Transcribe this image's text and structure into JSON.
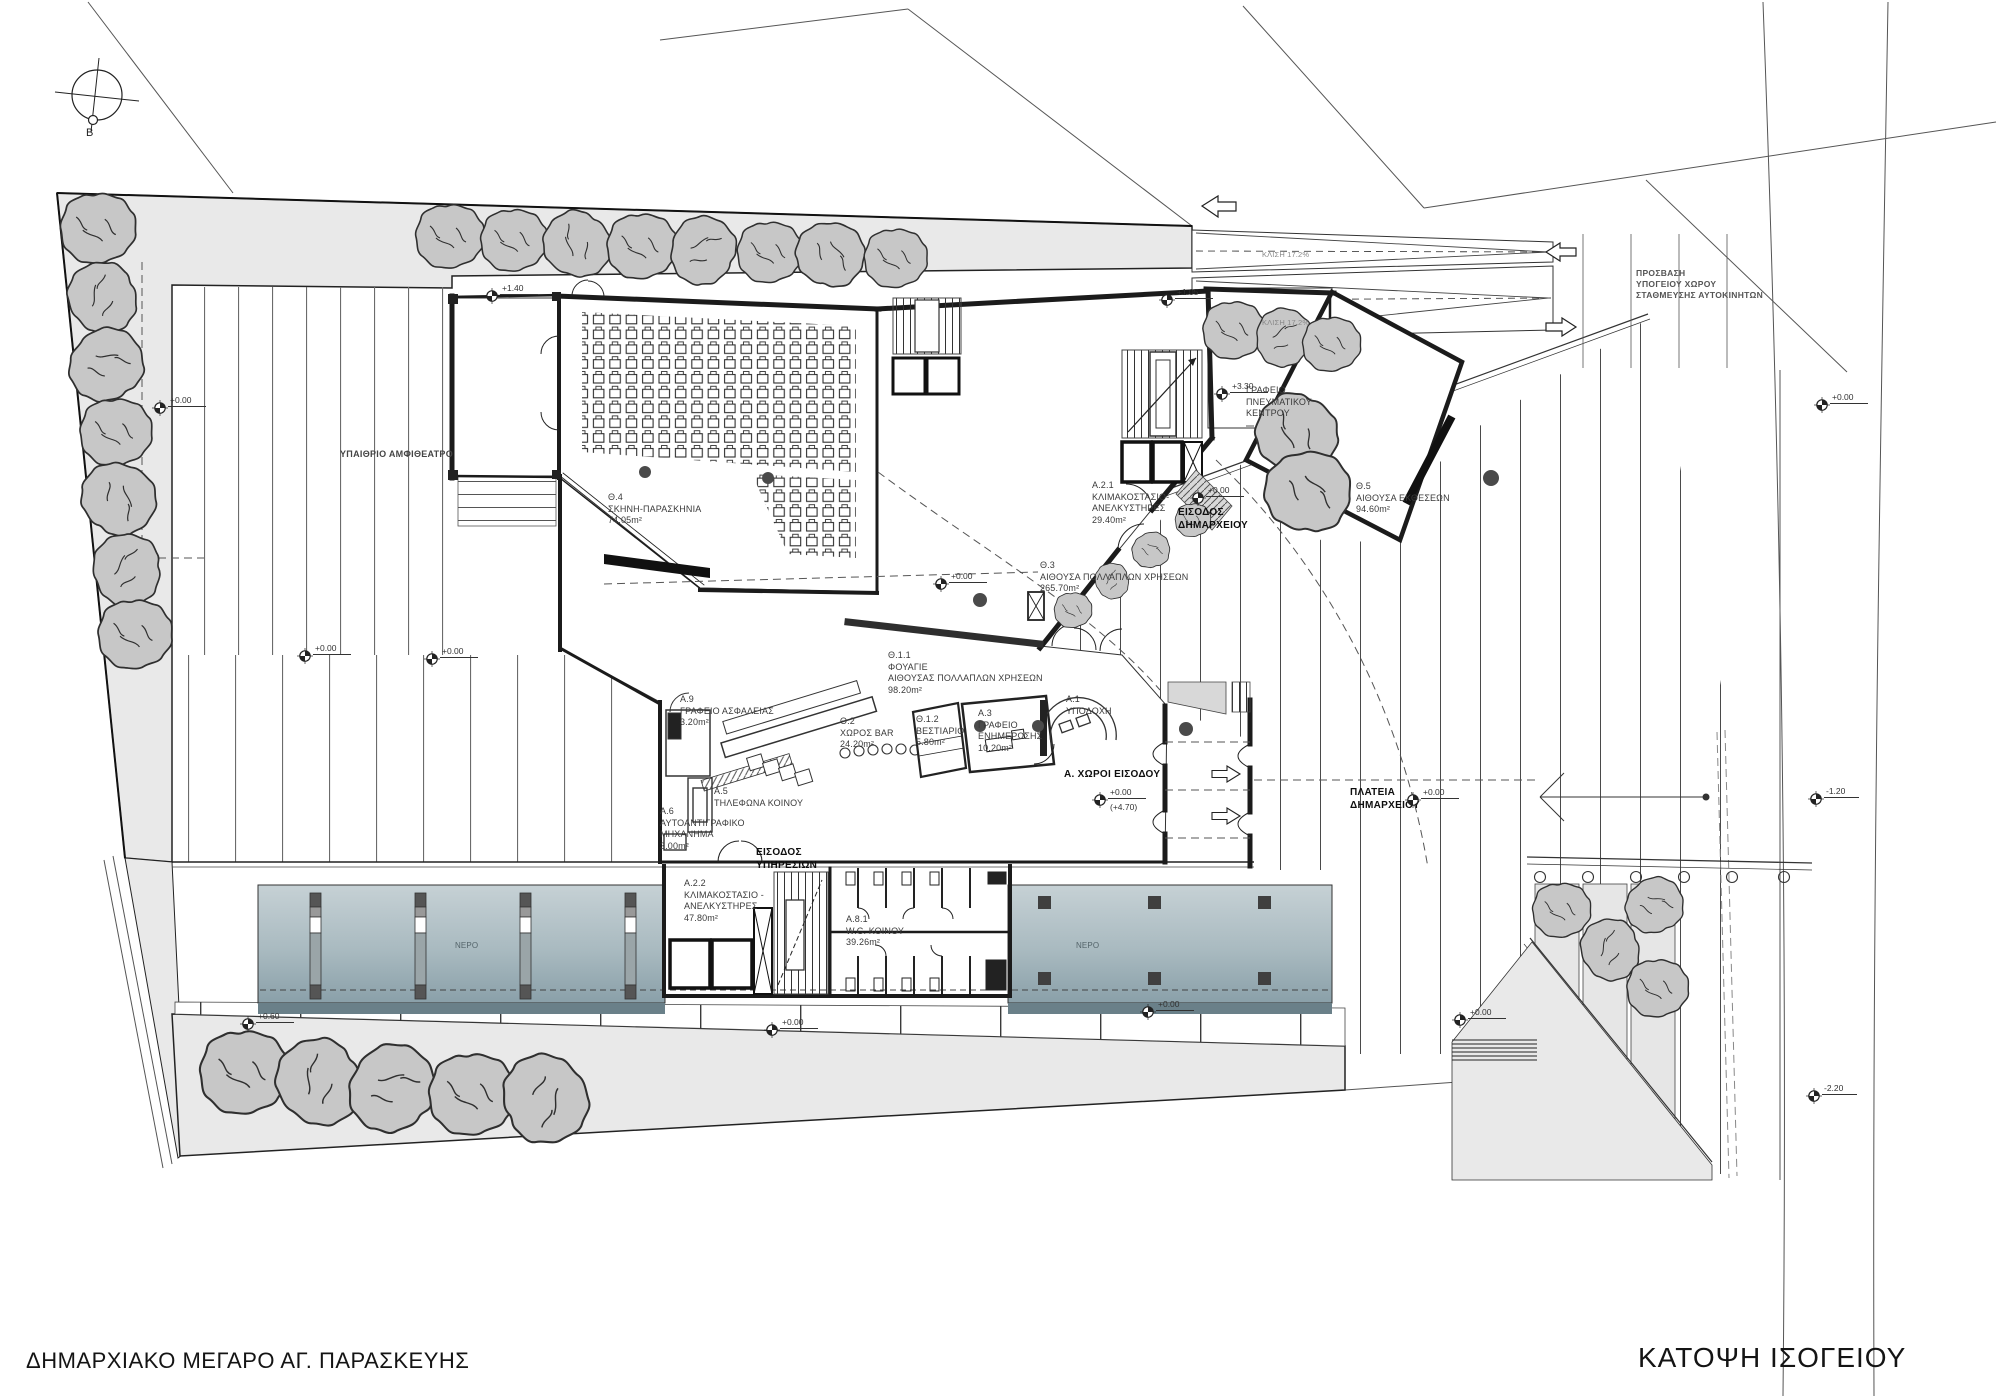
{
  "titles": {
    "project": "ΔΗΜΑΡΧΙΑΚΟ ΜΕΓΑΡΟ ΑΓ. ΠΑΡΑΣΚΕΥΗΣ",
    "drawing": "ΚΑΤΟΨΗ ΙΣΟΓΕΙΟΥ"
  },
  "colors": {
    "site_gray": "#e9e9e9",
    "tree_fill": "#c7c7c7",
    "wall": "#1b1b1b",
    "water_top": "#c6d1d5",
    "water_bottom": "#8aa0a9",
    "water_edge": "#6a8089",
    "canopy_gray": "#d8d8d8"
  },
  "plan_labels": [
    {
      "name": "compass-north-label",
      "text": "Β",
      "x": 86,
      "y": 126,
      "size": 11,
      "color": "#222222"
    },
    {
      "name": "area-open-amphitheater",
      "text": "ΥΠΑΙΘΡΙΟ ΑΜΦΙΘΕΑΤΡΟ",
      "x": 340,
      "y": 449,
      "size": 9,
      "bold": true,
      "color": "#444444"
    },
    {
      "name": "room-th4",
      "text": "Θ.4\nΣΚΗΝΗ-ΠΑΡΑΣΚΗΝΙΑ\n74.05m²",
      "x": 608,
      "y": 492
    },
    {
      "name": "room-th5",
      "text": "Θ.5\nΑΙΘΟΥΣΑ ΕΚΘΕΣΕΩΝ\n94.60m²",
      "x": 1356,
      "y": 481
    },
    {
      "name": "room-th3",
      "text": "Θ.3\nΑΙΘΟΥΣΑ ΠΟΛΛΑΠΛΩΝ ΧΡΗΣΕΩΝ\n265.70m²",
      "x": 1040,
      "y": 560
    },
    {
      "name": "room-th11",
      "text": "Θ.1.1\nΦΟΥΑΓΙΕ\nΑΙΘΟΥΣΑΣ ΠΟΛΛΑΠΛΩΝ ΧΡΗΣΕΩΝ\n98.20m²",
      "x": 888,
      "y": 650
    },
    {
      "name": "room-th2",
      "text": "Θ.2\nΧΩΡΟΣ BAR\n24.20m²",
      "x": 840,
      "y": 716
    },
    {
      "name": "room-th12",
      "text": "Θ.1.2\nΒΕΣΤΙΑΡΙΟ\n5.80m²",
      "x": 916,
      "y": 714
    },
    {
      "name": "room-a3",
      "text": "Α.3\nΓΡΑΦΕΙΟ\nΕΝΗΜΕΡΩΣΗΣ\n10.20m²",
      "x": 978,
      "y": 708
    },
    {
      "name": "room-a1",
      "text": "Α.1\nΥΠΟΔΟΧΗ",
      "x": 1066,
      "y": 694
    },
    {
      "name": "room-a9",
      "text": "Α.9\nΓΡΑΦΕΙΟ ΑΣΦΑΛΕΙΑΣ\n3.20m²",
      "x": 680,
      "y": 694
    },
    {
      "name": "room-a5",
      "text": "Α.5\nΤΗΛΕΦΩΝΑ ΚΟΙΝΟΥ",
      "x": 714,
      "y": 786
    },
    {
      "name": "room-a6",
      "text": "Α.6\nΑΥΤΟΑΝΤΙΓΡΑΦΙΚΟ\nΜΗΧΑΝΗΜΑ\n3.00m²",
      "x": 660,
      "y": 806
    },
    {
      "name": "room-a21",
      "text": "Α.2.1\nΚΛΙΜΑΚΟΣΤΑΣΙΟ-\nΑΝΕΛΚΥΣΤΗΡΕΣ\n29.40m²",
      "x": 1092,
      "y": 480
    },
    {
      "name": "room-a22",
      "text": "Α.2.2\nΚΛΙΜΑΚΟΣΤΑΣΙΟ -\nΑΝΕΛΚΥΣΤΗΡΕΣ\n47.80m²",
      "x": 684,
      "y": 878
    },
    {
      "name": "room-a81",
      "text": "Α.8.1\nW.C. ΚΟΙΝΟΥ\n39.26m²",
      "x": 846,
      "y": 914
    },
    {
      "name": "room-cultural-office",
      "text": "ΓΡΑΦΕΙΟ\nΠΝΕΥΜΑΤΙΚΟΥ\nΚΕΝΤΡΟΥ",
      "x": 1246,
      "y": 385
    },
    {
      "name": "entrance-city-hall",
      "text": "ΕΙΣΟΔΟΣ\nΔΗΜΑΡΧΕΙΟΥ",
      "x": 1178,
      "y": 506,
      "bold": true
    },
    {
      "name": "entrance-services",
      "text": "ΕΙΣΟΔΟΣ\nΥΠΗΡΕΣΙΩΝ",
      "x": 756,
      "y": 846,
      "bold": true
    },
    {
      "name": "area-entrance-spaces",
      "text": "Α. ΧΩΡΟΙ ΕΙΣΟΔΟΥ",
      "x": 1064,
      "y": 768,
      "bold": true
    },
    {
      "name": "area-city-hall-square",
      "text": "ΠΛΑΤΕΙΑ\nΔΗΜΑΡΧΕΙΟΥ",
      "x": 1350,
      "y": 786,
      "bold": true
    },
    {
      "name": "parking-access",
      "text": "ΠΡΟΣΒΑΣΗ\nΥΠΟΓΕΙΟΥ ΧΩΡΟΥ\nΣΤΑΘΜΕΥΣΗΣ ΑΥΤΟΚΙΝΗΤΩΝ",
      "x": 1636,
      "y": 268,
      "size": 8.5,
      "bold": true,
      "color": "#555555"
    },
    {
      "name": "ramp-slope-1",
      "text": "ΚΛΙΣΗ 17.2%",
      "x": 1262,
      "y": 250,
      "size": 7.5,
      "color": "#888888"
    },
    {
      "name": "ramp-slope-2",
      "text": "ΚΛΙΣΗ 17.2%",
      "x": 1262,
      "y": 318,
      "size": 7.5,
      "color": "#888888"
    },
    {
      "name": "water-label-1",
      "text": "ΝΕΡΟ",
      "x": 455,
      "y": 941,
      "size": 8,
      "color": "#54646a"
    },
    {
      "name": "water-label-2",
      "text": "ΝΕΡΟ",
      "x": 1076,
      "y": 941,
      "size": 8,
      "color": "#54646a"
    }
  ],
  "level_marks": [
    {
      "x": 492,
      "y": 296,
      "text": "+1.40"
    },
    {
      "x": 1167,
      "y": 300,
      "text": "+1.05"
    },
    {
      "x": 1222,
      "y": 394,
      "text": "+3.30"
    },
    {
      "x": 1198,
      "y": 498,
      "text": "+0.00"
    },
    {
      "x": 941,
      "y": 584,
      "text": "+0.00"
    },
    {
      "x": 1100,
      "y": 800,
      "text": "+0.00\n(+4.70)"
    },
    {
      "x": 1413,
      "y": 800,
      "text": "+0.00"
    },
    {
      "x": 305,
      "y": 656,
      "text": "+0.00"
    },
    {
      "x": 432,
      "y": 659,
      "text": "+0.00"
    },
    {
      "x": 248,
      "y": 1024,
      "text": "+0.60"
    },
    {
      "x": 160,
      "y": 408,
      "text": "+0.00"
    },
    {
      "x": 1822,
      "y": 405,
      "text": "+0.00"
    },
    {
      "x": 1816,
      "y": 799,
      "text": "-1.20"
    },
    {
      "x": 1814,
      "y": 1096,
      "text": "-2.20"
    },
    {
      "x": 1460,
      "y": 1020,
      "text": "+0.00"
    },
    {
      "x": 772,
      "y": 1030,
      "text": "+0.00"
    },
    {
      "x": 1148,
      "y": 1012,
      "text": "+0.00"
    }
  ]
}
